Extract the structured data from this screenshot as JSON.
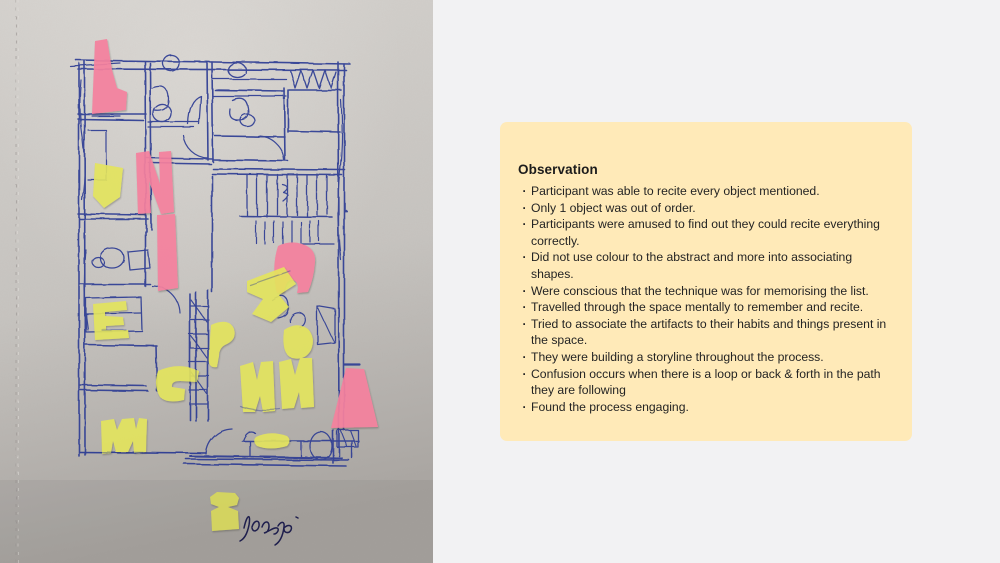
{
  "colors": {
    "page_bg": "#f2f2f3",
    "card_bg": "#ffeab8",
    "card_text": "#222222",
    "paper_light": "#d5d2ce",
    "paper_mid": "#c7c4c0",
    "paper_dark": "#a9a5a1",
    "pen_blue": "#2e3d94",
    "sticky_pink": "#f5819e",
    "sticky_yellow": "#e4e55c",
    "signature_ink": "#1c1c4e"
  },
  "photo": {
    "description": "Hand-drawn floor plan sketch in blue ballpoint pen on grey paper with pink and yellow sticky-note cutout shapes"
  },
  "card": {
    "title": "Observation",
    "bullet_char": "·",
    "bullets": [
      "Participant was able to recite every object mentioned.",
      "Only 1 object was out of order.",
      "Participants were amused to find out they could recite everything correctly.",
      "Did not use colour to the abstract and more into associating shapes.",
      "Were conscious that the technique was for memorising the list.",
      "Travelled through the space mentally to remember and recite.",
      "Tried to associate the artifacts to their habits and things present in the space.",
      "They were building a storyline throughout the process.",
      "Confusion occurs when there is a loop or back & forth in the path they are following",
      "Found the process engaging."
    ]
  }
}
